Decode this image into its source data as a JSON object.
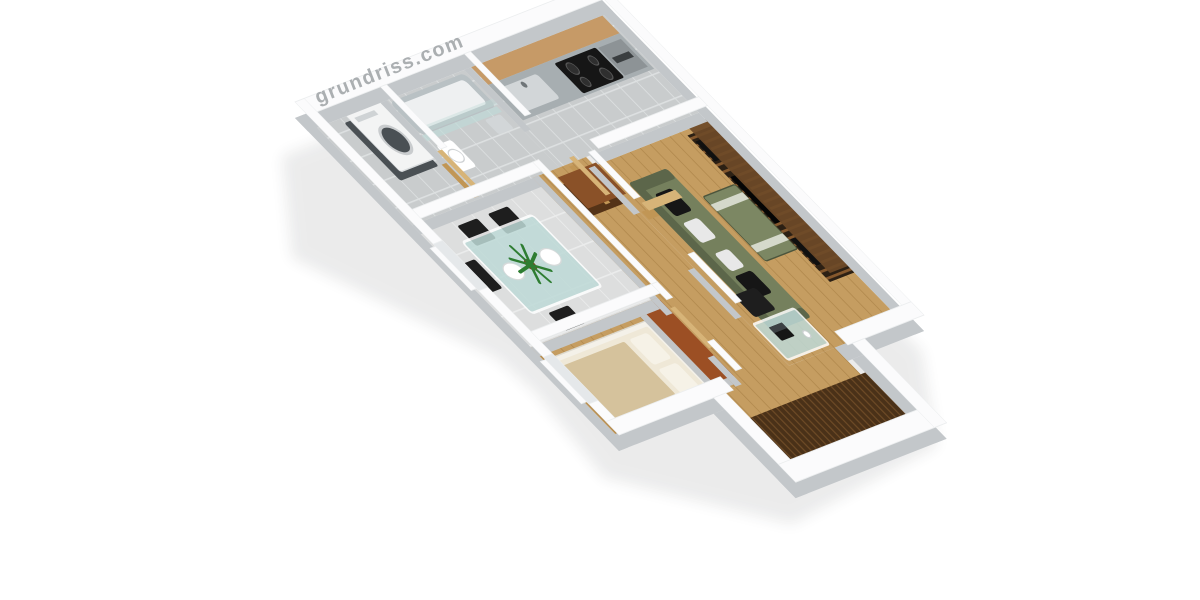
{
  "scene": {
    "description": "3D isometric rendering of a one-bedroom apartment floor plan on a white background",
    "watermark": {
      "text": "grundriss.com"
    },
    "rooms": [
      "laundry-nook",
      "bathroom",
      "kitchen",
      "dining-area",
      "bedroom",
      "hallway",
      "living-room",
      "balcony"
    ],
    "furniture": [
      "washing-machine",
      "bathtub-with-glass-screen",
      "toilet",
      "bathroom-basin",
      "kitchen-counter-with-sink",
      "cooktop",
      "oven",
      "upper-cabinets",
      "glass-dining-table",
      "dining-chairs-x4",
      "potted-plant",
      "double-bed",
      "wardrobe",
      "hallway-sideboard",
      "open-interior-doors",
      "zebra-wood-media-wall",
      "olive-sofa-with-pillows",
      "coffee-table",
      "glass-desk-with-laptop",
      "desk-chair",
      "dark-wood-balcony-decking",
      "balcony-parapet"
    ]
  },
  "colors": {
    "background": "#ffffff",
    "wall_top": "#fbfbfc",
    "wall_side": "#c3c7ca",
    "shadow": "#2a2e31",
    "tile_bath": "#c9cccd",
    "tile_grout": "#dde0e1",
    "tile_dining": "#dddede",
    "tile_grout2": "#ebecec",
    "wood_floor": "#c59d61",
    "wood_line": "#b0884c",
    "deck_dark": "#4a3118",
    "deck_line": "#6d4a26",
    "door_wood": "#c19655",
    "door_wood_top": "#d7b478",
    "cabinet_wood": "#c69a67",
    "counter_steel": "#a7aeb1",
    "sink_steel": "#d2d6d8",
    "cooktop_black": "#161616",
    "oven_steel": "#8d9396",
    "washer_white": "#f3f4f4",
    "washer_drum": "#4a5054",
    "tub_grey": "#b9c1c4",
    "tub_inner": "#eef0f1",
    "glass_blue": "#bedad7",
    "chair_black": "#1e1e1e",
    "plant_green": "#2e7d32",
    "plant_pot": "#7a4a26",
    "bed_frame": "#f4f1e9",
    "bed_mattress": "#efe8d7",
    "bed_beige": "#d5c29c",
    "pillow_cream": "#f6f2e7",
    "wardrobe_body": "#c2c5c7",
    "wardrobe_top": "#9c4f24",
    "sideboard_brown": "#553317",
    "sideboard_top": "#8a5128",
    "wallunit_dark": "#2c2014",
    "wallunit_stripe": "#85582d",
    "wallunit_top": "#6e4a28",
    "sofa_olive": "#75805d",
    "sofa_dark": "#5c664a",
    "pillow_black": "#161616",
    "pillow_white": "#e8e8e8",
    "coffee_table": "#7c8763",
    "coffee_stripe": "#dfe2d6",
    "window_glass": "#e5e8ea",
    "watermark": "#a7abae",
    "white": "#ffffff"
  }
}
